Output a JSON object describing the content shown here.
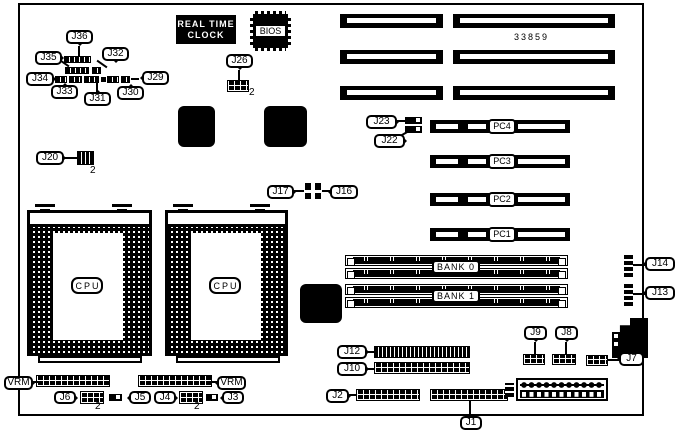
{
  "board": {
    "part_number": "33859",
    "rtc": {
      "line1": "REAL TIME",
      "line2": "CLOCK"
    },
    "bios_label": "BIOS",
    "cpu_label": "CPU",
    "vrm_label": "VRM",
    "pin2_label": "2",
    "memory": {
      "bank0": "BANK 0",
      "bank1": "BANK 1"
    },
    "pci_slots": {
      "pc1": "PC1",
      "pc2": "PC2",
      "pc3": "PC3",
      "pc4": "PC4"
    },
    "jumpers": {
      "j1": "J1",
      "j2": "J2",
      "j3": "J3",
      "j4": "J4",
      "j5": "J5",
      "j6": "J6",
      "j7": "J7",
      "j8": "J8",
      "j9": "J9",
      "j10": "J10",
      "j12": "J12",
      "j13": "J13",
      "j14": "J14",
      "j16": "J16",
      "j17": "J17",
      "j20": "J20",
      "j22": "J22",
      "j23": "J23",
      "j26": "J26",
      "j29": "J29",
      "j30": "J30",
      "j31": "J31",
      "j32": "J32",
      "j33": "J33",
      "j34": "J34",
      "j35": "J35",
      "j36": "J36"
    }
  }
}
